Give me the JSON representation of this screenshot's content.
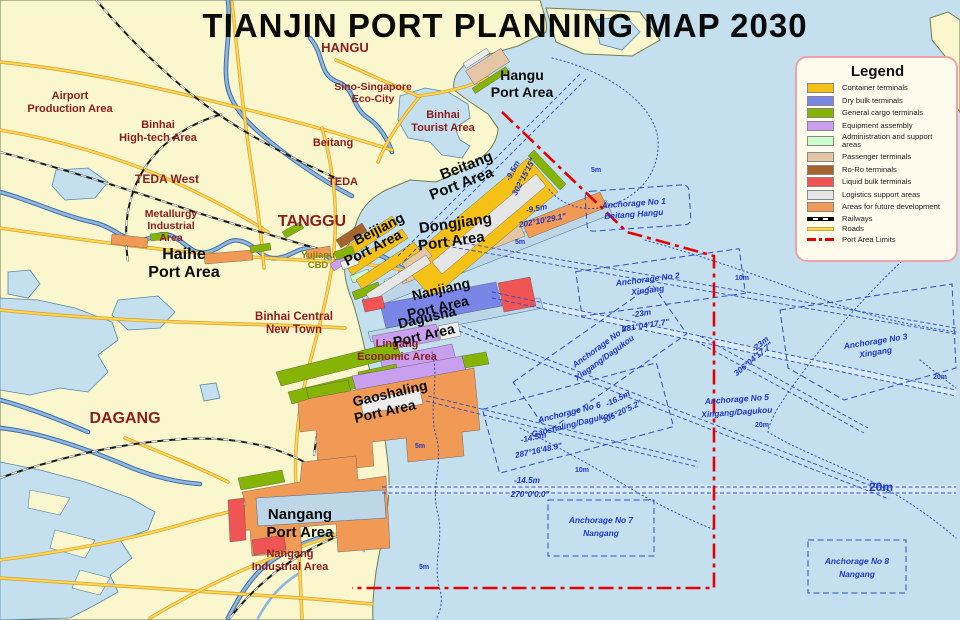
{
  "title": "TIANJIN PORT PLANNING MAP 2030",
  "colors": {
    "sea": "#C4E0EF",
    "land": "#FAF6CD",
    "road": "#FFD74F",
    "railway": "#000000",
    "river": "#8FB7DF",
    "port_limit": "#E60000",
    "channel_blue": "#2F4BC4",
    "region_label": "#8B1D1D",
    "anchorage_label": "#1F35C5",
    "port_label": "#0a0a0a"
  },
  "legend": {
    "title": "Legend",
    "items": [
      {
        "label": "Container terminals",
        "color": "#F5C116",
        "type": "swatch",
        "icon": "container-swatch"
      },
      {
        "label": "Dry bulk terminals",
        "color": "#7A85E8",
        "type": "swatch",
        "icon": "dry-bulk-swatch"
      },
      {
        "label": "General cargo terminals",
        "color": "#86B404",
        "type": "swatch",
        "icon": "general-cargo-swatch"
      },
      {
        "label": "Equipment assembly",
        "color": "#C9A0F0",
        "type": "swatch",
        "icon": "equipment-swatch"
      },
      {
        "label": "Administration and support areas",
        "color": "#CCFFCC",
        "type": "swatch",
        "icon": "administration-swatch"
      },
      {
        "label": "Passenger terminals",
        "color": "#E4C6A5",
        "type": "swatch",
        "icon": "passenger-swatch"
      },
      {
        "label": "Ro-Ro terminals",
        "color": "#A5632E",
        "type": "swatch",
        "icon": "roro-swatch"
      },
      {
        "label": "Liquid bulk terminals",
        "color": "#F15454",
        "type": "swatch",
        "icon": "liquid-bulk-swatch"
      },
      {
        "label": "Logistics support areas",
        "color": "#E6E6E6",
        "type": "swatch",
        "icon": "logistics-swatch"
      },
      {
        "label": "Areas for future development",
        "color": "#F09A55",
        "type": "swatch",
        "icon": "future-development-swatch"
      },
      {
        "label": "Railways",
        "color": "#000000",
        "type": "railway",
        "icon": "railway-line"
      },
      {
        "label": "Roads",
        "color": "#FFD74F",
        "type": "road",
        "icon": "road-line"
      },
      {
        "label": "Port Area Limits",
        "color": "#E60000",
        "type": "limit",
        "icon": "port-limit-line"
      }
    ]
  },
  "regions": {
    "hangu": "HANGU",
    "airport_l1": "Airport",
    "airport_l2": "Production Area",
    "hitech_l1": "Binhai",
    "hitech_l2": "High-tech Area",
    "teda_west": "TEDA West",
    "metallurgy_l1": "Metallurgy",
    "metallurgy_l2": "Industrial",
    "metallurgy_l3": "Area",
    "tanggu": "TANGGU",
    "teda": "TEDA",
    "beitang": "Beitang",
    "sino_l1": "Sino-Singapore",
    "sino_l2": "Eco-City",
    "tourist_l1": "Binhai",
    "tourist_l2": "Tourist Area",
    "yujiapu_l1": "Yujiapu",
    "yujiapu_l2": "CBD",
    "central_l1": "Binhai Central",
    "central_l2": "New Town",
    "lingang_l1": "Lingang",
    "lingang_l2": "Economic Area",
    "dagang": "DAGANG",
    "nangang_ind_l1": "Nangang",
    "nangang_ind_l2": "Industrial Area"
  },
  "ports": {
    "haihe_l1": "Haihe",
    "haihe_l2": "Port Area",
    "hangu_l1": "Hangu",
    "hangu_l2": "Port Area",
    "beitang_l1": "Beitang",
    "beitang_l2": "Port Area",
    "dongjiang_l1": "Dongjiang",
    "dongjiang_l2": "Port Area",
    "beijiang_l1": "Beijiang",
    "beijiang_l2": "Port Area",
    "nanjiang_l1": "Nanjiang",
    "nanjiang_l2": "Port Area",
    "dagusha_l1": "Dagusha",
    "dagusha_l2": "Port Area",
    "gaoshaling_l1": "Gaoshaling",
    "gaoshaling_l2": "Port Area",
    "nangang_l1": "Nangang",
    "nangang_l2": "Port Area"
  },
  "anchorages": {
    "a1_l1": "Anchorage No 1",
    "a1_l2": "Beitang Hangu",
    "a2_l1": "Anchorage No 2",
    "a2_l2": "Xingang",
    "a3_l1": "Anchorage No 3",
    "a3_l2": "Xingang",
    "a4_l1": "Anchorage No 4",
    "a4_l2": "Xingang/Dagukou",
    "a5_l1": "Anchorage No 5",
    "a5_l2": "Xingang/Dagukou",
    "a6_l1": "Anchorage No 6",
    "a6_l2": "Gaoshaling/Dagukou",
    "a7_l1": "Anchorage No 7",
    "a7_l2": "Nangang",
    "a8_l1": "Anchorage No 8",
    "a8_l2": "Nangang"
  },
  "channels": {
    "hangu_depth": "-9.5m",
    "hangu_bearing": "302°15'15\"",
    "beitang_depth": "-9.5m",
    "beitang_bearing": "202°10'29.1\"",
    "xingang_depth": "-23m",
    "xingang_bearing": "281°04'17.7\"",
    "branch_depth": "-23m",
    "branch_bearing": "306°04'17.7\"",
    "dagusha_depth": "-16.5m",
    "dagusha_bearing": "305°20'5.2\"",
    "gaoshaling_depth": "-14.5m",
    "gaoshaling_bearing": "287°16'48.9\"",
    "nangang_depth": "-14.5m",
    "nangang_bearing": "270°0'0.0\""
  },
  "contours": {
    "d5": "5m",
    "d10": "10m",
    "d20": "20m",
    "d20_big": "20m"
  }
}
